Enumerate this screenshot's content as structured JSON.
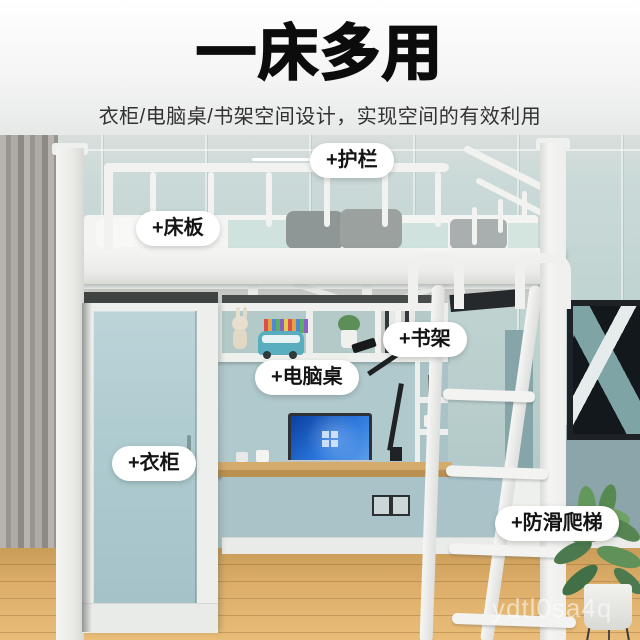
{
  "header": {
    "title": "一床多用",
    "subtitle": "衣柜/电脑桌/书架空间设计，实现空间的有效利用"
  },
  "annotations": {
    "guardrail": "+护栏",
    "bed_board": "+床板",
    "bookshelf": "+书架",
    "computer_desk": "+电脑桌",
    "wardrobe": "+衣柜",
    "antislip_ladder": "+防滑爬梯"
  },
  "watermark": "ydtl0sa4q",
  "palette": {
    "title_black": "#0c0c0c",
    "wall_mint": "#bfd3d2",
    "wall_accent_lower": "#8ba5aa",
    "frame_white": "#f2f2f0",
    "wardrobe_teal": "#aecbd0",
    "blanket_mint": "#cfe2dd",
    "pillow_gray": "#949b9b",
    "desk_wood": "#d5ab6c",
    "floor_wood": "#dcae6a",
    "laptop_screen_blue": "#2b77dd",
    "plant_green": "#5a8b55",
    "artwork_teal": "#7ea4a6"
  }
}
